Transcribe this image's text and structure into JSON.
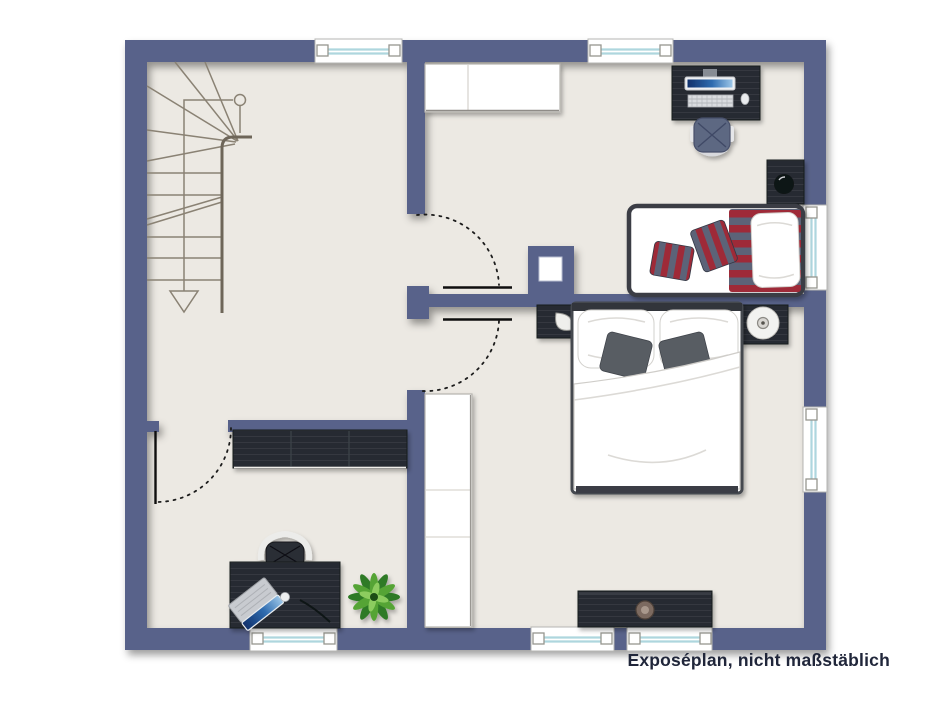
{
  "caption": "Exposéplan, nicht maßstäblich",
  "colors": {
    "wall": "#59628a",
    "floor": "#ece9e3",
    "furn_dark": "#282c31",
    "furn_grain": "#3a4048",
    "stair": "#8a8274",
    "stair_bold": "#6e6659",
    "glass": "#aed6de",
    "stripe_red": "#9e2a38",
    "stripe_slate": "#5c6478",
    "cushion": "#595d64",
    "plant_dark": "#2f7a26",
    "plant_mid": "#55a436",
    "plant_light": "#8ccc5e",
    "screen_dark": "#10306b",
    "screen_mid": "#2f6cb0",
    "screen_light": "#9cc6e8",
    "text": "#20263a"
  },
  "furniture": [
    "staircase",
    "wardrobe",
    "tall-wardrobe",
    "desk",
    "monitor",
    "keyboard",
    "computer-mouse",
    "office-chair",
    "nightstand",
    "table-lamp",
    "single-bed",
    "striped-duvet",
    "striped-cushion",
    "double-bed",
    "pillow",
    "duvet",
    "round-bedside-lamp",
    "sideboard",
    "lowboard",
    "laptop",
    "desk-chair",
    "potted-plant",
    "decorative-bowl",
    "chimney"
  ],
  "elements": {
    "windows": 7,
    "doors": 3,
    "rooms": 4
  }
}
